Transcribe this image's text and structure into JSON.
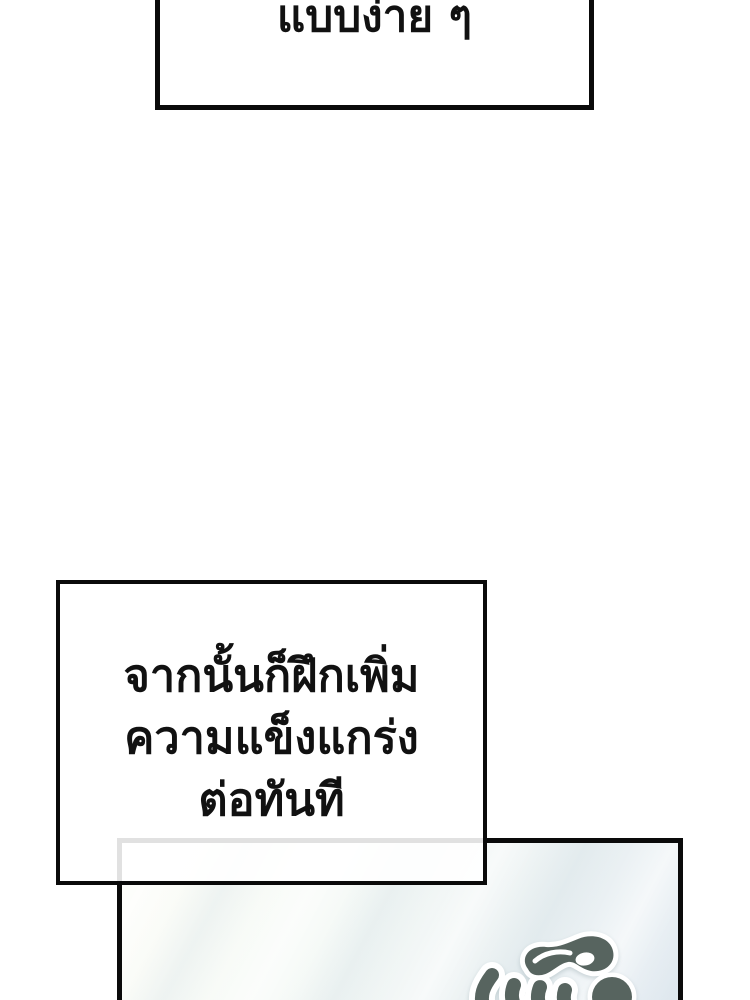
{
  "bubbles": {
    "top": {
      "text": "แบบง่าย ๆ"
    },
    "middle": {
      "lines": [
        "จากนั้นก็ฝึกเพิ่ม",
        "ความแข็งแกร่ง",
        "ต่อทันที"
      ]
    }
  },
  "panel": {
    "border_color": "#0a0a0a",
    "bg_top": "#fdfdf8",
    "bg_bottom": "#e6edf3",
    "sfx": {
      "icon": "thai-sfx-lettering",
      "color": "#57645f",
      "outline": "#ffffff"
    }
  },
  "colors": {
    "page_bg": "#ffffff",
    "bubble_fill": "#ffffff",
    "bubble_border": "#0a0a0a",
    "text": "#111111",
    "faint_overlap_line": "#e3e3e3"
  }
}
